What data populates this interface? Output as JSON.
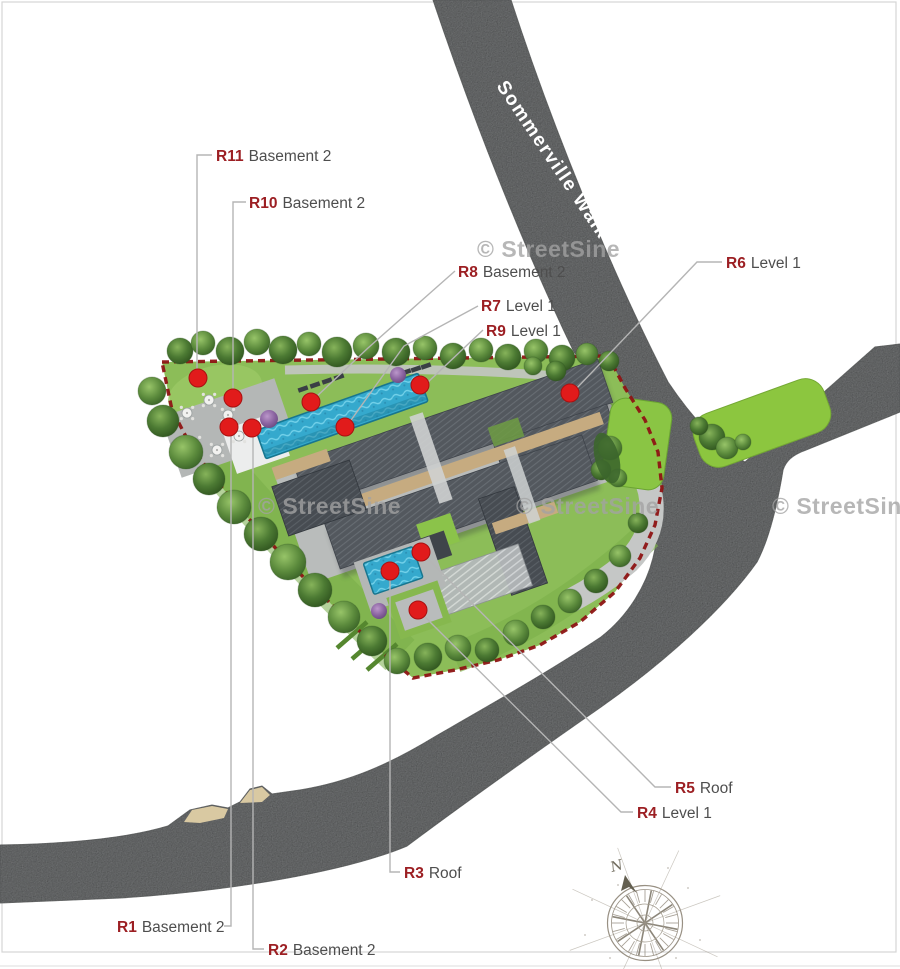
{
  "street": {
    "name": "Sommerville Walk"
  },
  "watermark": {
    "text": "© StreetSine"
  },
  "compass": {
    "north_label": "N"
  },
  "markers": [
    {
      "id": "R1",
      "location": "Basement 2"
    },
    {
      "id": "R2",
      "location": "Basement 2"
    },
    {
      "id": "R3",
      "location": "Roof"
    },
    {
      "id": "R4",
      "location": "Level 1"
    },
    {
      "id": "R5",
      "location": "Roof"
    },
    {
      "id": "R6",
      "location": "Level 1"
    },
    {
      "id": "R7",
      "location": "Level 1"
    },
    {
      "id": "R8",
      "location": "Basement 2"
    },
    {
      "id": "R9",
      "location": "Level 1"
    },
    {
      "id": "R10",
      "location": "Basement 2"
    },
    {
      "id": "R11",
      "location": "Basement 2"
    }
  ]
}
